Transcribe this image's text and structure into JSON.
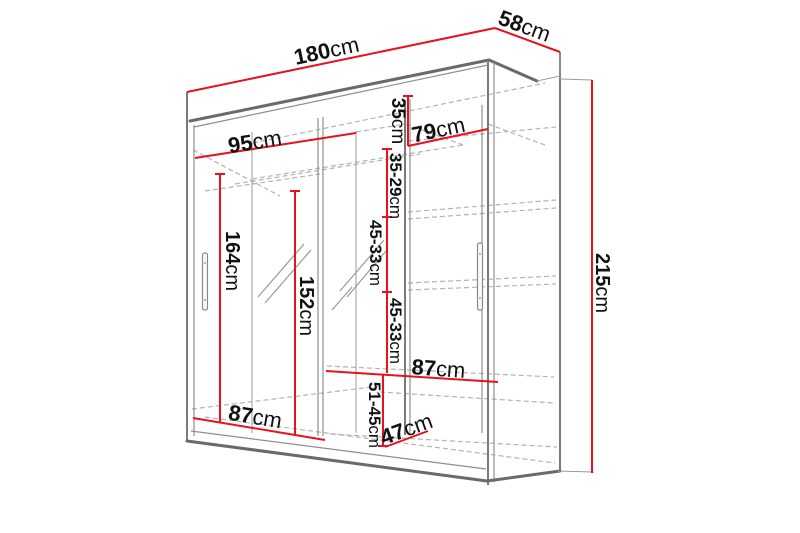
{
  "diagram": {
    "type": "furniture-dimension-drawing",
    "subject": "two-door sliding wardrobe with mirror",
    "background": "#ffffff",
    "dimension_color": "#e8111c",
    "line_color": "#6a6a6a",
    "hidden_line_color": "#b3b3b3",
    "text_color": "#111111"
  },
  "dims": {
    "width": {
      "value": "180",
      "unit": "cm"
    },
    "depth": {
      "value": "58",
      "unit": "cm"
    },
    "height": {
      "value": "215",
      "unit": "cm"
    },
    "door_left": {
      "value": "95",
      "unit": "cm"
    },
    "door_right": {
      "value": "79",
      "unit": "cm"
    },
    "top_shelf": {
      "value": "35",
      "unit": "cm"
    },
    "gap1": {
      "value": "35-29",
      "unit": "cm"
    },
    "gap2": {
      "value": "45-33",
      "unit": "cm"
    },
    "gap3": {
      "value": "45-33",
      "unit": "cm"
    },
    "hang_left": {
      "value": "164",
      "unit": "cm"
    },
    "hang_mid": {
      "value": "152",
      "unit": "cm"
    },
    "shelf_left": {
      "value": "87",
      "unit": "cm"
    },
    "shelf_mid": {
      "value": "87",
      "unit": "cm"
    },
    "gap_bottom": {
      "value": "51-45",
      "unit": "cm"
    },
    "depth_bottom": {
      "value": "47",
      "unit": "cm"
    }
  }
}
